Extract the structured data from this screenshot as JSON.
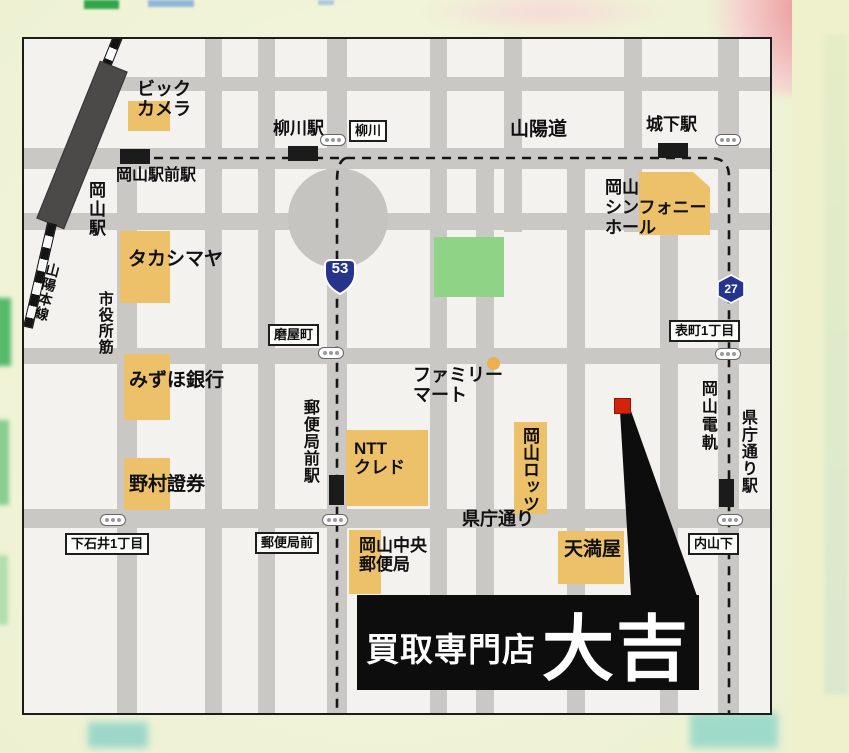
{
  "colors": {
    "building_orange": "#edc169",
    "park_green": "#8ed386",
    "road_gray": "#c9c8c5",
    "marker_red": "#d2230c",
    "shield_blue": "#27348b",
    "banner_black": "#0d0d0d"
  },
  "map": {
    "railway": {
      "station_label": "岡山駅",
      "line_label": "山陽本線"
    },
    "stations": [
      {
        "id": "okayama-ekimae",
        "label": "岡山駅前駅"
      },
      {
        "id": "yanagawa",
        "label": "柳川駅"
      },
      {
        "id": "shiroshita",
        "label": "城下駅"
      },
      {
        "id": "yubinkyokumae",
        "label": "郵便局前駅"
      },
      {
        "id": "kenchodori",
        "label": "県庁通り駅"
      }
    ],
    "signs": [
      {
        "id": "yanagawa",
        "label": "柳川"
      },
      {
        "id": "togiyacho",
        "label": "磨屋町"
      },
      {
        "id": "omotecho-1chome",
        "label": "表町1丁目"
      },
      {
        "id": "shimoishii-1chome",
        "label": "下石井1丁目"
      },
      {
        "id": "yubinkyokumae",
        "label": "郵便局前"
      },
      {
        "id": "uchisange",
        "label": "内山下"
      }
    ],
    "roads": {
      "sanyodo": "山陽道",
      "kenchodori": "県庁通り",
      "shiyakushosuji": "市役所筋",
      "okayamadenki": "岡山電軌"
    },
    "route_shields": [
      {
        "type": "national-route",
        "number": "53"
      },
      {
        "type": "prefectural-route",
        "number": "27"
      }
    ],
    "buildings": [
      {
        "id": "bic-camera",
        "label": "ビック\nカメラ"
      },
      {
        "id": "takashimaya",
        "label": "タカシマヤ"
      },
      {
        "id": "mizuho-bank",
        "label": "みずほ銀行"
      },
      {
        "id": "nomura-securities",
        "label": "野村證券"
      },
      {
        "id": "ntt-cred",
        "label": "NTT\nクレド"
      },
      {
        "id": "okayama-central-post-office",
        "label": "岡山中央\n郵便局"
      },
      {
        "id": "okayama-lotz",
        "label": "岡山ロッツ"
      },
      {
        "id": "tenmaya",
        "label": "天満屋"
      },
      {
        "id": "symphony-hall",
        "label": "岡山\nシンフォニー\nホール"
      },
      {
        "id": "familymart",
        "label": "ファミリー\nマート"
      }
    ],
    "store_banner": {
      "prefix": "買取専門店",
      "name": "大吉"
    }
  }
}
